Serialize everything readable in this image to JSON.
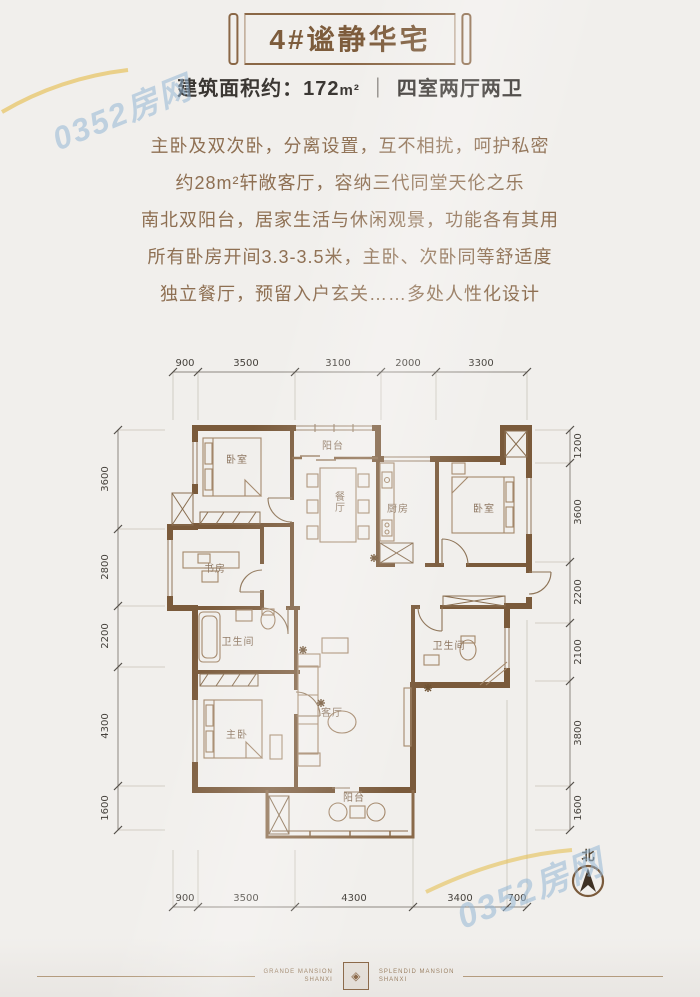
{
  "banner": {
    "title": "4#谧静华宅"
  },
  "subtitle": {
    "area_label": "建筑面积约：",
    "area_value": "172",
    "area_unit": "m²",
    "divider": "｜",
    "layout": "四室两厅两卫"
  },
  "description": {
    "lines": [
      "主卧及双次卧，分离设置，互不相扰，呵护私密",
      "约28m²轩敞客厅，容纳三代同堂天伦之乐",
      "南北双阳台，居家生活与休闲观景，功能各有其用",
      "所有卧房开间3.3-3.5米，主卧、次卧同等舒适度",
      "独立餐厅，预留入户玄关……多处人性化设计"
    ]
  },
  "plan": {
    "rooms": {
      "bedroom_nw": "卧室",
      "balcony_north": "阳台",
      "dining": "餐厅",
      "kitchen": "厨房",
      "bedroom_ne": "卧室",
      "study": "书房",
      "bath_west": "卫生间",
      "bath_east": "卫生间",
      "master": "主卧",
      "living": "客厅",
      "balcony_south": "阳台"
    },
    "dims_top": [
      "900",
      "3500",
      "3100",
      "2000",
      "3300"
    ],
    "dims_bottom": [
      "900",
      "3500",
      "4300",
      "3400",
      "700"
    ],
    "dims_left": [
      "3600",
      "2800",
      "2200",
      "4300",
      "1600"
    ],
    "dims_right": [
      "1200",
      "3600",
      "2200",
      "2100",
      "3800",
      "1600"
    ],
    "north_label": "北"
  },
  "watermark": {
    "text": "0352房网"
  },
  "footer": {
    "left_line1": "GRANDE MANSION",
    "left_line2": "SHANXI",
    "right_line1": "SPLENDID MANSION",
    "right_line2": "SHANXI"
  },
  "colors": {
    "wall_brown": "#7a5a3b",
    "title_brown": "#7d5c3c",
    "body_brown": "#8e6f52",
    "watermark_blue": "#94b6d6",
    "background": "#f1efec"
  }
}
